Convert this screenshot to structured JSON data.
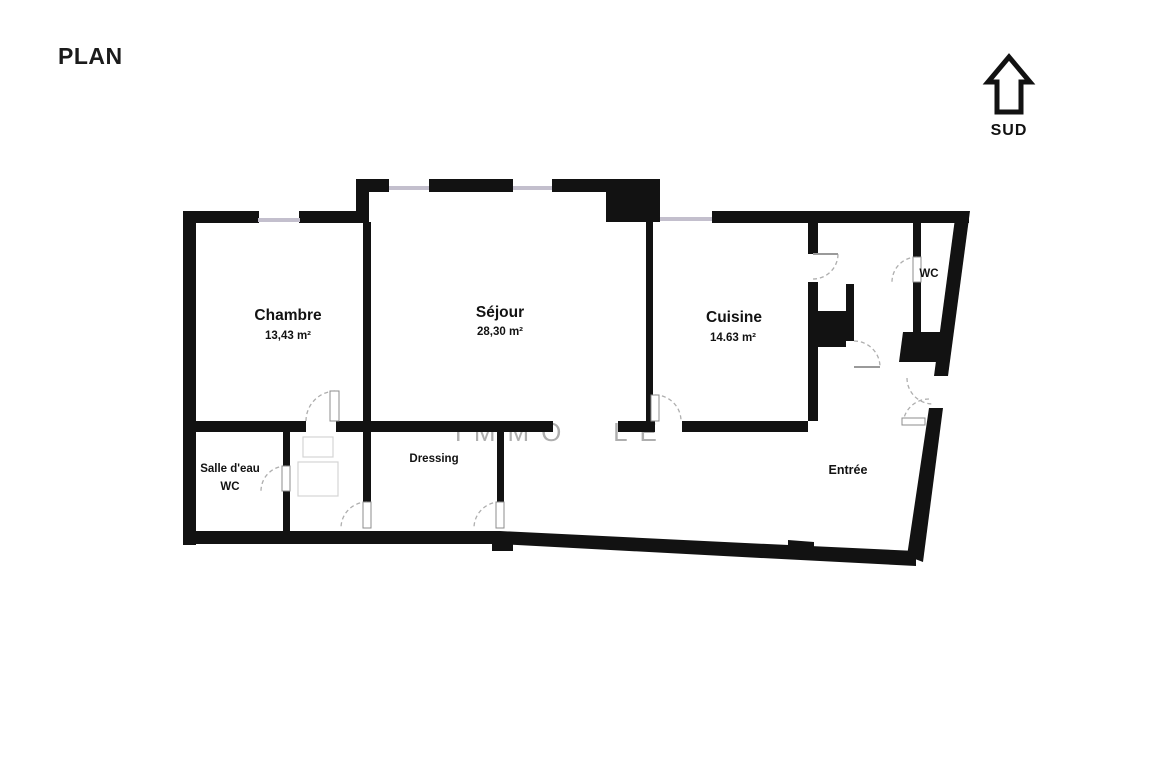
{
  "header": {
    "title": "PLAN"
  },
  "compass": {
    "label": "SUD",
    "arrow_icon": "arrow-up-outline-icon"
  },
  "watermark": {
    "part1": "IMMO",
    "part2": "LE"
  },
  "rooms": {
    "chambre": {
      "name": "Chambre",
      "area": "13,43 m²"
    },
    "sejour": {
      "name": "Séjour",
      "area": "28,30 m²"
    },
    "cuisine": {
      "name": "Cuisine",
      "area": "14.63 m²"
    },
    "wc": {
      "name": "WC"
    },
    "salle_eau": {
      "name": "Salle d'eau",
      "sub": "WC"
    },
    "dressing": {
      "name": "Dressing"
    },
    "entree": {
      "name": "Entrée"
    }
  },
  "colors": {
    "wall": "#121212",
    "window_line": "#c3bfcd",
    "door_arc": "#aeaeae",
    "watermark": "#9b9b9b",
    "background": "#ffffff"
  }
}
